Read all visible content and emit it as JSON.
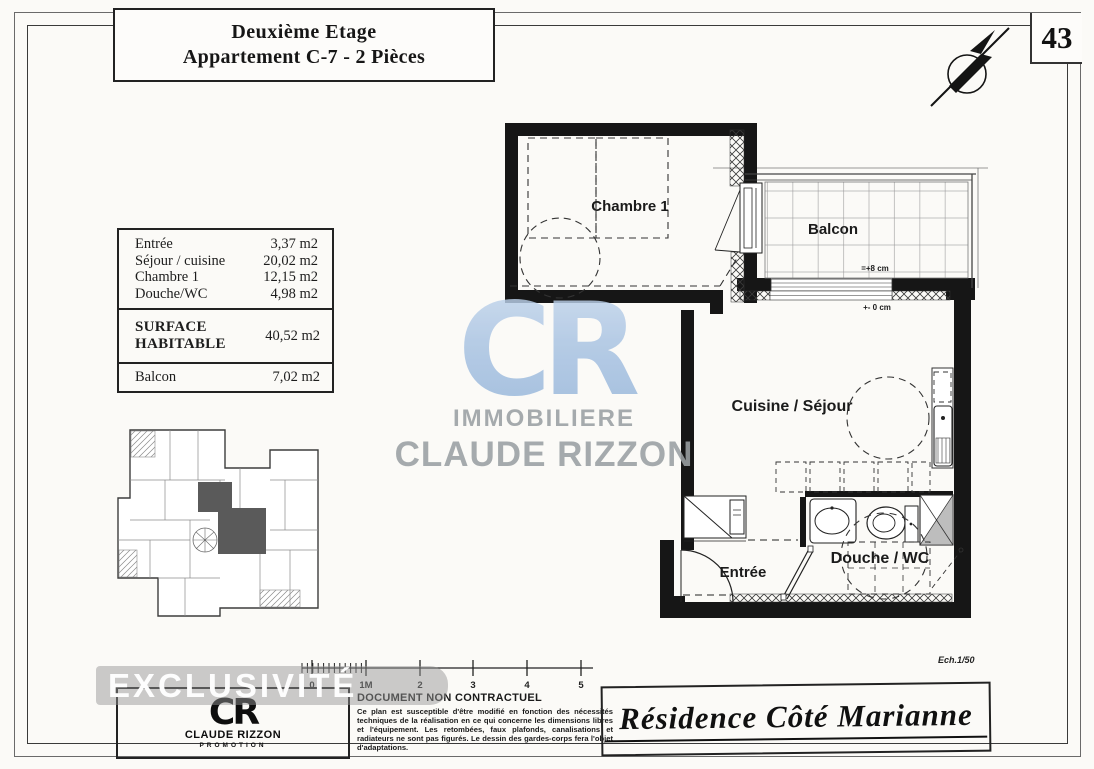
{
  "page": {
    "number": "43"
  },
  "title_block": {
    "line1": "Deuxième Etage",
    "line2": "Appartement C-7 -  2 Pièces"
  },
  "area_table": {
    "rows": [
      {
        "label": "Entrée",
        "value": "3,37 m2"
      },
      {
        "label": "Séjour / cuisine",
        "value": "20,02 m2"
      },
      {
        "label": "Chambre 1",
        "value": "12,15 m2"
      },
      {
        "label": "Douche/WC",
        "value": "4,98 m2"
      }
    ],
    "surface_label_1": "SURFACE",
    "surface_label_2": "HABITABLE",
    "surface_value": "40,52 m2",
    "balcony_label": "Balcon",
    "balcony_value": "7,02 m2"
  },
  "plan": {
    "rooms": {
      "bedroom": "Chambre 1",
      "balcony": "Balcon",
      "living": "Cuisine / Séjour",
      "bath": "Douche / WC",
      "entry": "Entrée"
    },
    "annotations": {
      "balcony_level": "=+8 cm",
      "ground_level": "+- 0 cm"
    },
    "scale_note": "Ech.1/50"
  },
  "watermark": {
    "monogram": "CR",
    "line1": "IMMOBILIERE",
    "line2": "CLAUDE RIZZON",
    "blue": "#a7c2e2",
    "gray": "#9aa0a3"
  },
  "banner": {
    "label": "EXCLUSIVITÉ"
  },
  "scale_bar": {
    "labels": [
      "0",
      "1M",
      "2",
      "3",
      "4",
      "5"
    ]
  },
  "footer": {
    "logo": {
      "monogram": "CR",
      "name": "CLAUDE RIZZON",
      "subtitle": "PROMOTION"
    },
    "disclaimer_title": "DOCUMENT NON CONTRACTUEL",
    "disclaimer_body": "Ce plan est susceptible d'être modifié en fonction des nécessités techniques de la réalisation en ce qui concerne les dimensions libres et l'équipement. Les retombées, faux plafonds, canalisations et radiateurs ne sont pas figurés. Le dessin des gardes-corps fera l'objet d'adaptations.",
    "project_name": "Résidence Côté Marianne"
  },
  "icons": {
    "compass": "north-arrow-compass"
  }
}
